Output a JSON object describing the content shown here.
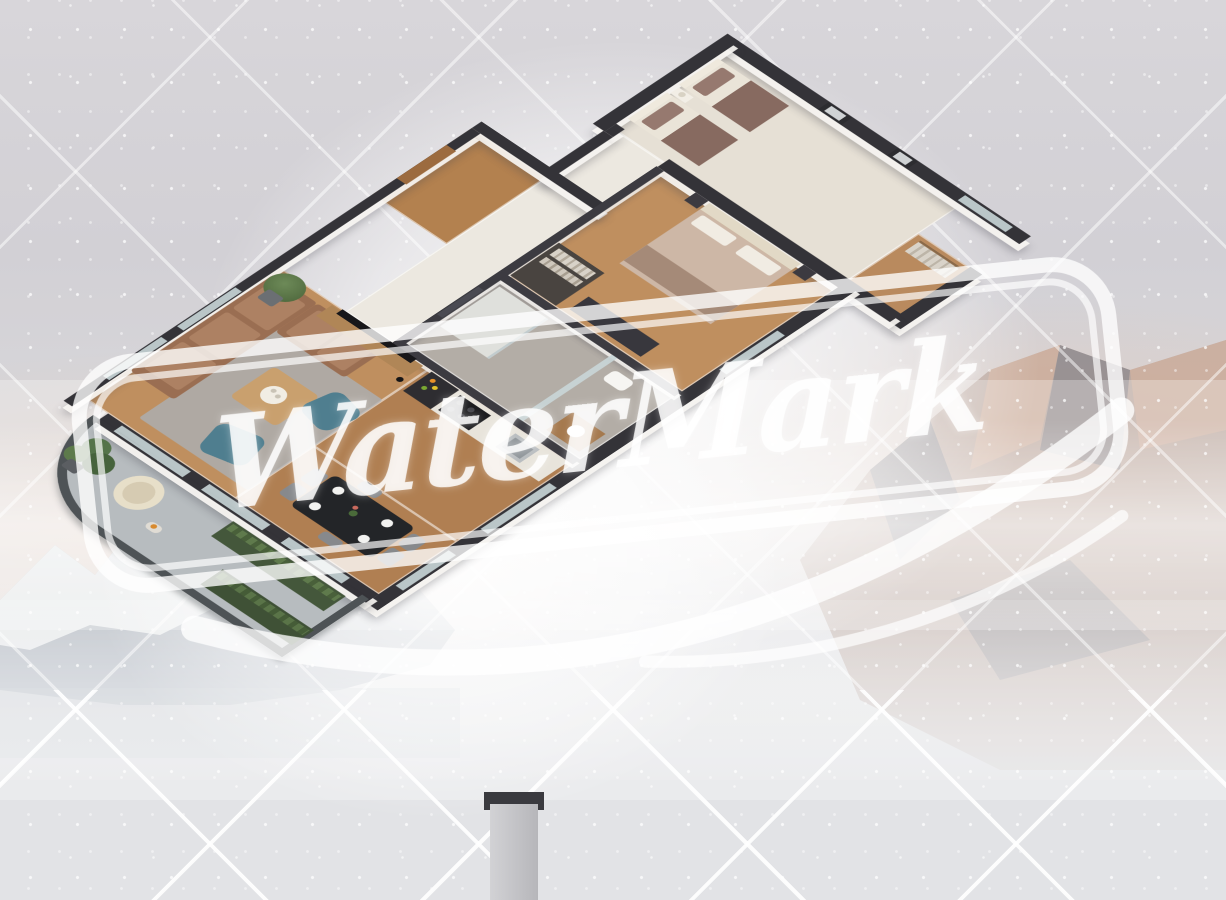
{
  "scene": {
    "type": "isometric-3d-floor-plan-render",
    "description": "Cutaway 3D render of a two-bedroom apartment with balcony, floating over a hazy snowy mountain backdrop with speckled gray sky and diagonal crosshatch lines, overlaid by a large white watermark stamp"
  },
  "watermark": {
    "text": "WaterMark",
    "color": "#ffffff",
    "opacity": 0.8,
    "rotation_deg": -6,
    "elements": [
      "rounded-double-border",
      "script-text",
      "brush-swoosh"
    ]
  },
  "background": {
    "sky_color": "#d5d3d7",
    "ground_color": "#e2e3e6",
    "speckle_color": "#ffffff",
    "crosshatch_color": "#ffffff",
    "alpenglow_color": "#e6c8b4",
    "mountains": {
      "left_ridge": {
        "rock": "#8e99a6",
        "snow": "#eceeef",
        "shadow": "#5f6670"
      },
      "right_massif": {
        "rock": "#a98f84",
        "lit": "#d9b5a0",
        "shadow": "#6e7683"
      },
      "fog": "#ffffff"
    }
  },
  "floorplan": {
    "wall_color": "#343338",
    "wall_side_color": "#f4f2ef",
    "wood_floor": "#bf8f5f",
    "rooms": [
      {
        "name": "entry-hall",
        "floor": "wood",
        "furniture": [
          "entry-door"
        ]
      },
      {
        "name": "hallway",
        "floor": "light-tile",
        "furniture": [
          "wall-mirror"
        ]
      },
      {
        "name": "kids-bedroom",
        "floor": "light-carpet",
        "furniture": [
          "single-bed",
          "single-bed",
          "nightstand",
          "table-lamp",
          "wall-art",
          "wall-art",
          "open-wardrobe-nook"
        ]
      },
      {
        "name": "master-bedroom",
        "floor": "wood",
        "furniture": [
          "double-bed",
          "tufted-headboard",
          "nightstand",
          "nightstand",
          "dresser",
          "walk-in-closet"
        ]
      },
      {
        "name": "bathroom",
        "floor": "marble",
        "furniture": [
          "walk-in-shower",
          "glass-partition",
          "toilet",
          "vanity-sink"
        ]
      },
      {
        "name": "living-room",
        "floor": "wood",
        "furniture": [
          "corner-sofa",
          "coffee-table",
          "area-rug",
          "accent-armchair",
          "accent-armchair",
          "tv-console",
          "tv-panel",
          "potted-plant",
          "floor-lamp"
        ]
      },
      {
        "name": "kitchen",
        "floor": "wood",
        "furniture": [
          "tall-cabinet",
          "counter-run",
          "cooktop",
          "sink",
          "decor-tray"
        ]
      },
      {
        "name": "dining-area",
        "floor": "wood",
        "furniture": [
          "dining-table",
          "dining-chair",
          "dining-chair",
          "dining-chair",
          "dining-chair",
          "dining-chair",
          "dining-chair",
          "plates",
          "flower-vase"
        ]
      },
      {
        "name": "balcony",
        "floor": "stone-tile",
        "furniture": [
          "chevron-railing",
          "planter-box",
          "planter-box",
          "monstera-plant",
          "egg-chair",
          "fruit-bowl"
        ]
      }
    ],
    "structure": [
      "anthracite-cut-walls",
      "glass-windows",
      "concrete-pillar",
      "white-wall-sides"
    ]
  },
  "palette": {
    "sofa_brown": "#9a6e52",
    "armchair_teal": "#4f7e8f",
    "bed_mauve": "#876a60",
    "dining_table_black": "#232528",
    "railing_gray": "#4e5356",
    "plant_green": "#5d7a4b",
    "marble_gray": "#b3ada6",
    "carpet_cream": "#e6e0d5",
    "door_wood": "#9c6b3f"
  }
}
